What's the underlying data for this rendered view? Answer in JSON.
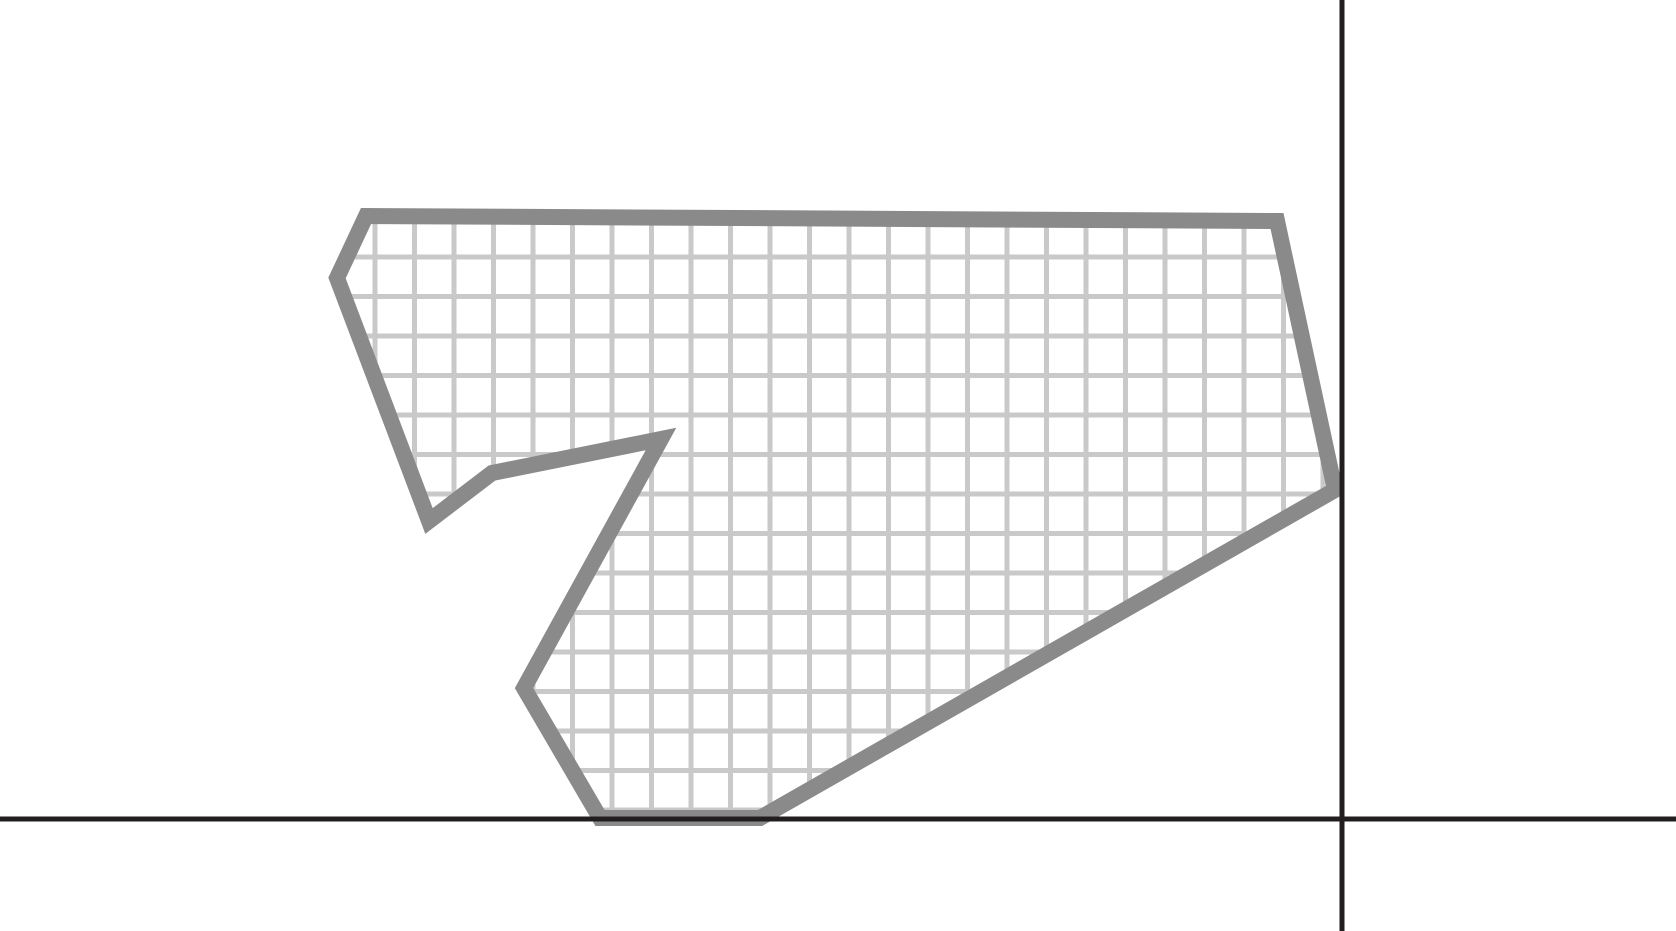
{
  "figure": {
    "description": "Irregular ten-sided polygon with a square-grid hatch fill, drawn in the upper-left quadrant of a coordinate plane",
    "canvas": {
      "width": 1676,
      "height": 931,
      "background_color": "#ffffff"
    },
    "axes": {
      "color": "#221d1e",
      "thickness": 5,
      "x_axis": {
        "y": 819,
        "from_x": 0,
        "to_x": 1676
      },
      "y_axis": {
        "x": 1342,
        "from_y": 0,
        "to_y": 931
      }
    },
    "polygon": {
      "stroke_color": "#8a8a8a",
      "stroke_width": 16,
      "stroke_join": "miter",
      "fill_background": "#ffffff",
      "grid_fill": {
        "cell_size": 39.5,
        "line_width": 5,
        "line_color": "#c9c9c9",
        "first_vertical_line_x": 375,
        "first_horizontal_line_y": 257
      },
      "vertices": [
        [
          366,
          216
        ],
        [
          1277,
          221
        ],
        [
          1335,
          490
        ],
        [
          760,
          818
        ],
        [
          600,
          818
        ],
        [
          524,
          688
        ],
        [
          661,
          439
        ],
        [
          492,
          473
        ],
        [
          429,
          521
        ],
        [
          337,
          278
        ]
      ]
    }
  }
}
